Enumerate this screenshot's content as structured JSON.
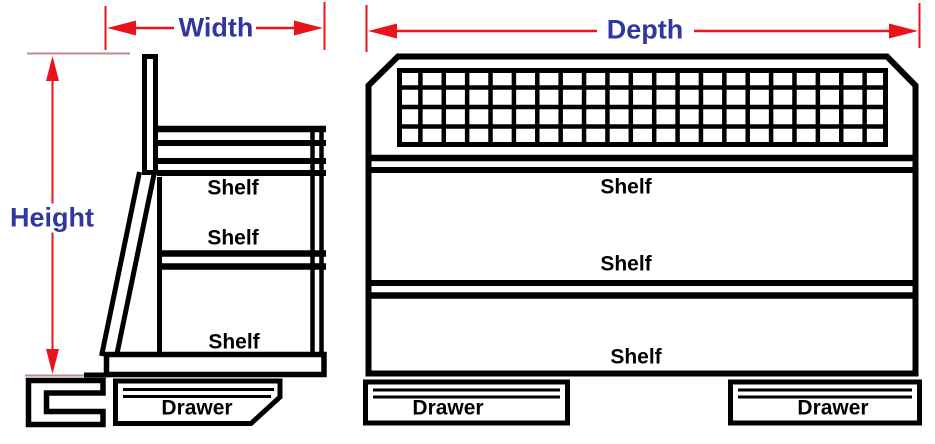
{
  "colors": {
    "label_blue": "#31379e",
    "dimension_red": "#e8141c",
    "extension_red": "#bc8c8c",
    "line_black": "#000000"
  },
  "side_view": {
    "width_dimension_label": "Width",
    "height_dimension_label": "Height",
    "shelf_labels": [
      "Shelf",
      "Shelf",
      "Shelf"
    ],
    "drawer_labels": [
      "Drawer"
    ]
  },
  "front_view": {
    "depth_dimension_label": "Depth",
    "shelf_labels": [
      "Shelf",
      "Shelf",
      "Shelf"
    ],
    "drawer_labels": [
      "Drawer",
      "Drawer"
    ],
    "mesh_grid": {
      "rows": 4,
      "columns": 21
    }
  }
}
